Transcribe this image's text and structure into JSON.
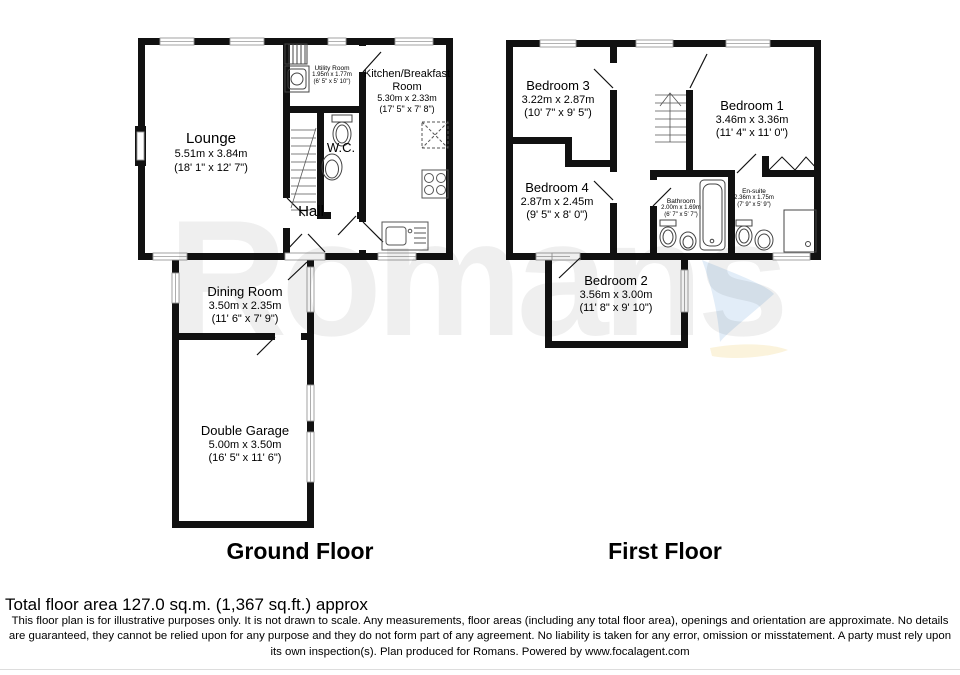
{
  "watermark": "Romans",
  "accent_colors": {
    "wall": "#111111",
    "watermark_gray": "#efefef",
    "swoosh_blue": "#e2edf8",
    "swoosh_yellow": "#fbf3dc"
  },
  "floors": [
    {
      "label": "Ground Floor",
      "rooms": [
        {
          "name": "Lounge",
          "metric": "5.51m x 3.84m",
          "imperial": "(18' 1\" x 12' 7\")"
        },
        {
          "name": "Utility Room",
          "metric": "1.95m x 1.77m",
          "imperial": "(6' 5\" x 5' 10\")"
        },
        {
          "name": "Kitchen/Breakfast Room",
          "metric": "5.30m x 2.33m",
          "imperial": "(17' 5\" x 7' 8\")"
        },
        {
          "name": "W.C."
        },
        {
          "name": "Hall"
        },
        {
          "name": "Dining Room",
          "metric": "3.50m x 2.35m",
          "imperial": "(11' 6\" x 7' 9\")"
        },
        {
          "name": "Double Garage",
          "metric": "5.00m x 3.50m",
          "imperial": "(16' 5\" x 11' 6\")"
        }
      ]
    },
    {
      "label": "First Floor",
      "rooms": [
        {
          "name": "Bedroom 3",
          "metric": "3.22m x 2.87m",
          "imperial": "(10' 7\" x 9' 5\")"
        },
        {
          "name": "Bedroom 1",
          "metric": "3.46m x 3.36m",
          "imperial": "(11' 4\" x 11' 0\")"
        },
        {
          "name": "Bedroom 4",
          "metric": "2.87m x 2.45m",
          "imperial": "(9' 5\" x 8' 0\")"
        },
        {
          "name": "Bathroom",
          "metric": "2.00m x 1.69m",
          "imperial": "(6' 7\" x 5' 7\")"
        },
        {
          "name": "En-suite",
          "metric": "2.36m x 1.75m",
          "imperial": "(7' 9\" x 5' 9\")"
        },
        {
          "name": "Bedroom 2",
          "metric": "3.56m x 3.00m",
          "imperial": "(11' 8\" x 9' 10\")"
        }
      ]
    }
  ],
  "footer": {
    "total_area": "Total floor area 127.0 sq.m. (1,367 sq.ft.) approx",
    "disclaimer": "This floor plan is for illustrative purposes only. It is not drawn to scale. Any measurements, floor areas (including any total floor area), openings and orientation are approximate. No details are guaranteed, they cannot be relied upon for any purpose and they do not form part of any agreement. No liability is taken for any error, omission or misstatement. A party must rely upon its own inspection(s). Plan produced for Romans. Powered by www.focalagent.com"
  }
}
